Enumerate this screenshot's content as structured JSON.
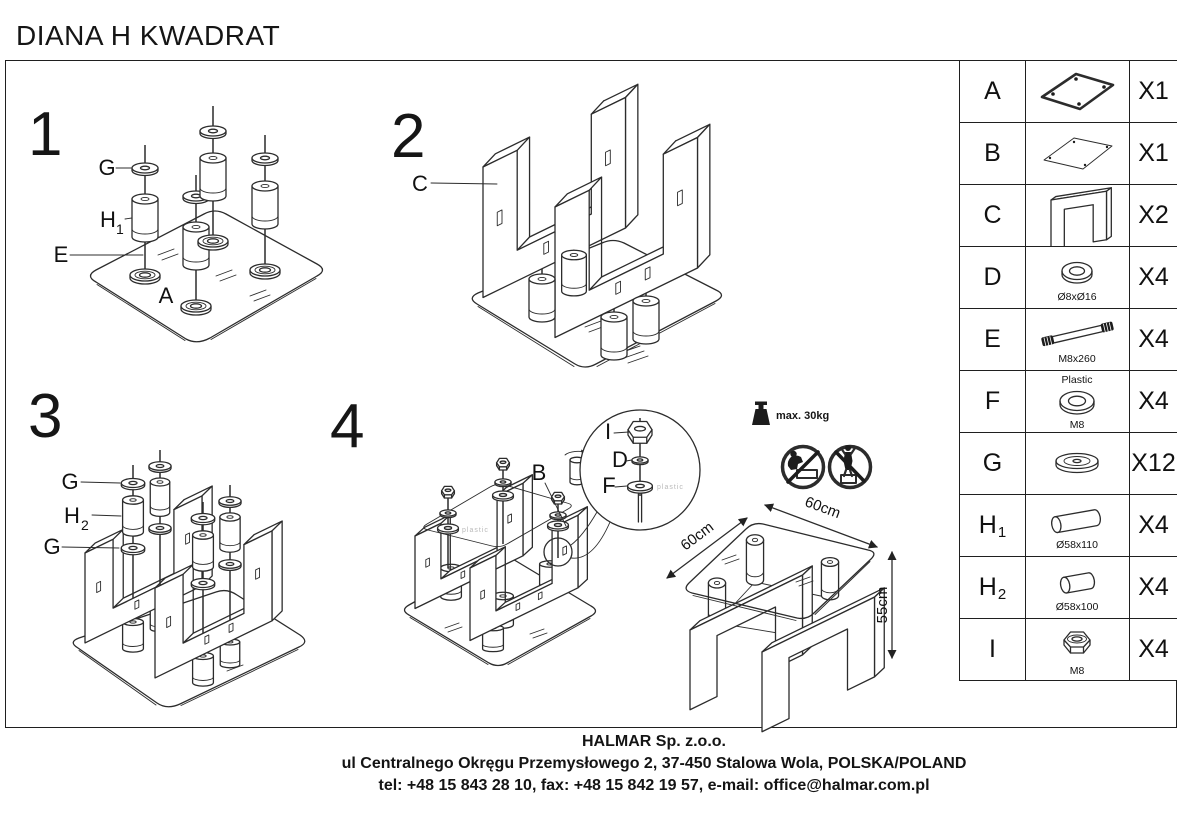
{
  "title": "DIANA H KWADRAT",
  "step1": {
    "number": "1",
    "label_g": "G",
    "label_h": "H",
    "label_h_sub": "1",
    "label_e": "E",
    "label_a": "A"
  },
  "step2": {
    "number": "2",
    "label_c": "C"
  },
  "step3": {
    "number": "3",
    "label_g_top": "G",
    "label_h": "H",
    "label_h_sub": "2",
    "label_g_bottom": "G"
  },
  "step4": {
    "number": "4",
    "label_b": "B",
    "label_i": "I",
    "label_d": "D",
    "label_f": "F",
    "plastic_note": "plastic"
  },
  "warnings": {
    "max_load": "max. 30kg"
  },
  "dimensions": {
    "top": "60cm",
    "left": "60cm",
    "height": "55cm"
  },
  "parts": {
    "rows": [
      {
        "id": "A",
        "qty": "X1"
      },
      {
        "id": "B",
        "qty": "X1"
      },
      {
        "id": "C",
        "qty": "X2"
      },
      {
        "id": "D",
        "qty": "X4",
        "spec": "Ø8xØ16"
      },
      {
        "id": "E",
        "qty": "X4",
        "spec": "M8x260"
      },
      {
        "id": "F",
        "qty": "X4",
        "spec_top": "Plastic",
        "spec": "M8"
      },
      {
        "id": "G",
        "qty": "X12"
      },
      {
        "id": "H",
        "sub": "1",
        "qty": "X4",
        "spec": "Ø58x110"
      },
      {
        "id": "H",
        "sub": "2",
        "qty": "X4",
        "spec": "Ø58x100"
      },
      {
        "id": "I",
        "qty": "X4",
        "spec": "M8"
      }
    ]
  },
  "footer": {
    "company": "HALMAR Sp. z.o.o.",
    "address": "ul Centralnego Okręgu Przemysłowego 2, 37-450 Stalowa Wola, POLSKA/POLAND",
    "contact": "tel: +48 15 843 28 10, fax: +48 15 842 19 57, e-mail: office@halmar.com.pl"
  }
}
